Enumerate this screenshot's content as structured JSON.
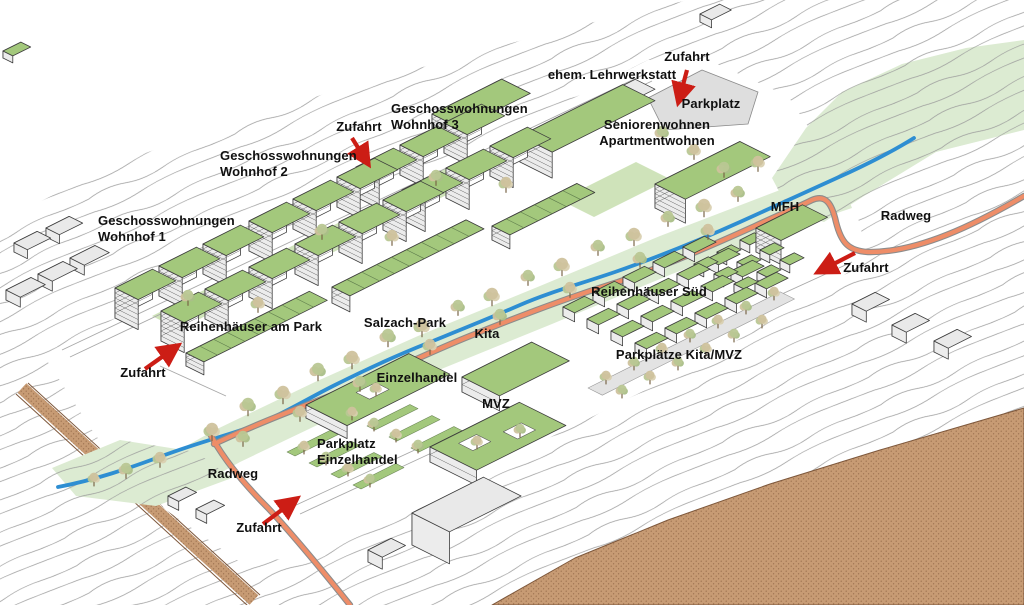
{
  "labels": {
    "zufahrt": "Zufahrt",
    "radweg": "Radweg",
    "ehem_lehrwerkstatt": "ehem. Lehrwerkstatt",
    "parkplatz": "Parkplatz",
    "seniorenwohnen_1": "Seniorenwohnen",
    "seniorenwohnen_2": "Apartmentwohnen",
    "geschosswohnungen": "Geschosswohnungen",
    "wohnhof_1": "Wohnhof 1",
    "wohnhof_2": "Wohnhof 2",
    "wohnhof_3": "Wohnhof 3",
    "mfh": "MFH",
    "reihenhaeuser_sued": "Reihenhäuser Süd",
    "parkplaetze_kita_mvz": "Parkplätze Kita/MVZ",
    "reihenhaeuser_am_park": "Reihenhäuser am Park",
    "salzach_park": "Salzach-Park",
    "kita": "Kita",
    "einzelhandel": "Einzelhandel",
    "mvz": "MVZ"
  },
  "colors": {
    "roof_green": "#a3c87c",
    "courtyard_green": "#cfe3ba",
    "park_green": "#dcebd2",
    "stream_blue": "#2e8ed2",
    "path_orange": "#ee8d68",
    "terrain_brown": "#c79b74",
    "arrow_red": "#cc1d15",
    "contour_gray": "#9b9b9b"
  }
}
